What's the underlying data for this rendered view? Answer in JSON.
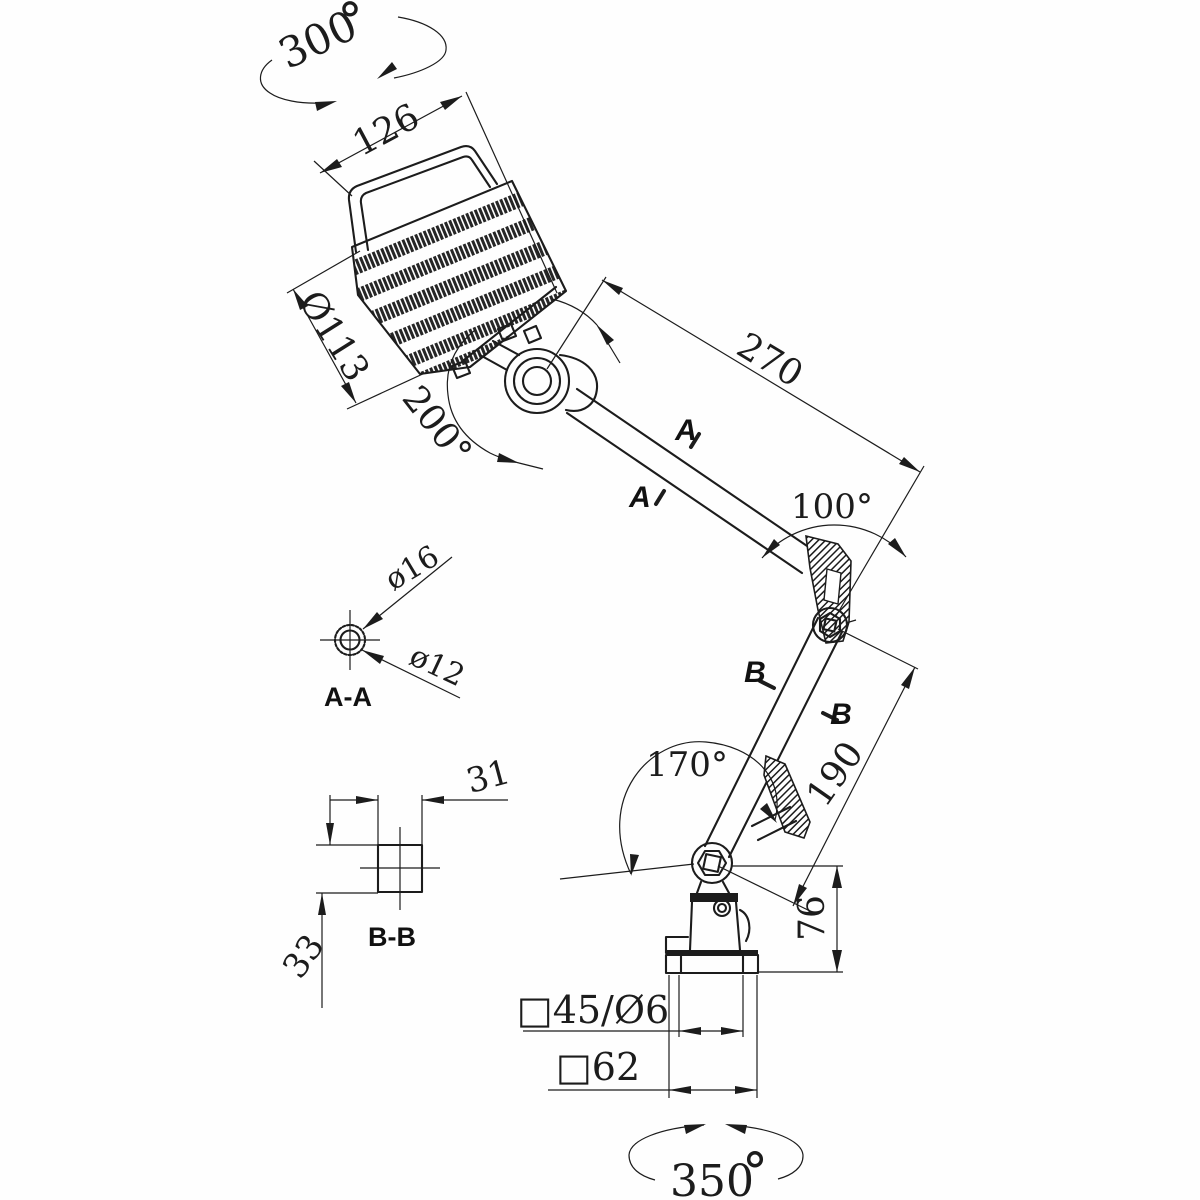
{
  "drawing": {
    "kind": "engineering dimensional drawing",
    "subject": "articulated machine work lamp with ribbed head, two arms and mounting base",
    "ink_color": "#1c1c1c",
    "background_color": "#fefefe"
  },
  "labels": {
    "rotation_head": {
      "value": "300",
      "degree": "°"
    },
    "head_width": "126",
    "head_diameter": "Ø113",
    "head_swivel_angle": "200°",
    "upper_arm_length": "270",
    "elbow_angle": "100°",
    "section_a_mark_1": "A",
    "section_a_mark_2": "A",
    "section_aa_title": "A-A",
    "section_aa_outer_dia": "ø16",
    "section_aa_inner_dia": "ø12",
    "section_b_mark_1": "B",
    "section_b_mark_2": "B",
    "section_bb_title": "B-B",
    "section_bb_width": "31",
    "section_bb_height": "33",
    "base_joint_angle": "170°",
    "lower_arm_length": "190",
    "base_height": "76",
    "base_hole_pattern": "□45/Ø6",
    "base_plate_size": "□62",
    "rotation_base": {
      "value": "350",
      "degree": "°"
    }
  }
}
